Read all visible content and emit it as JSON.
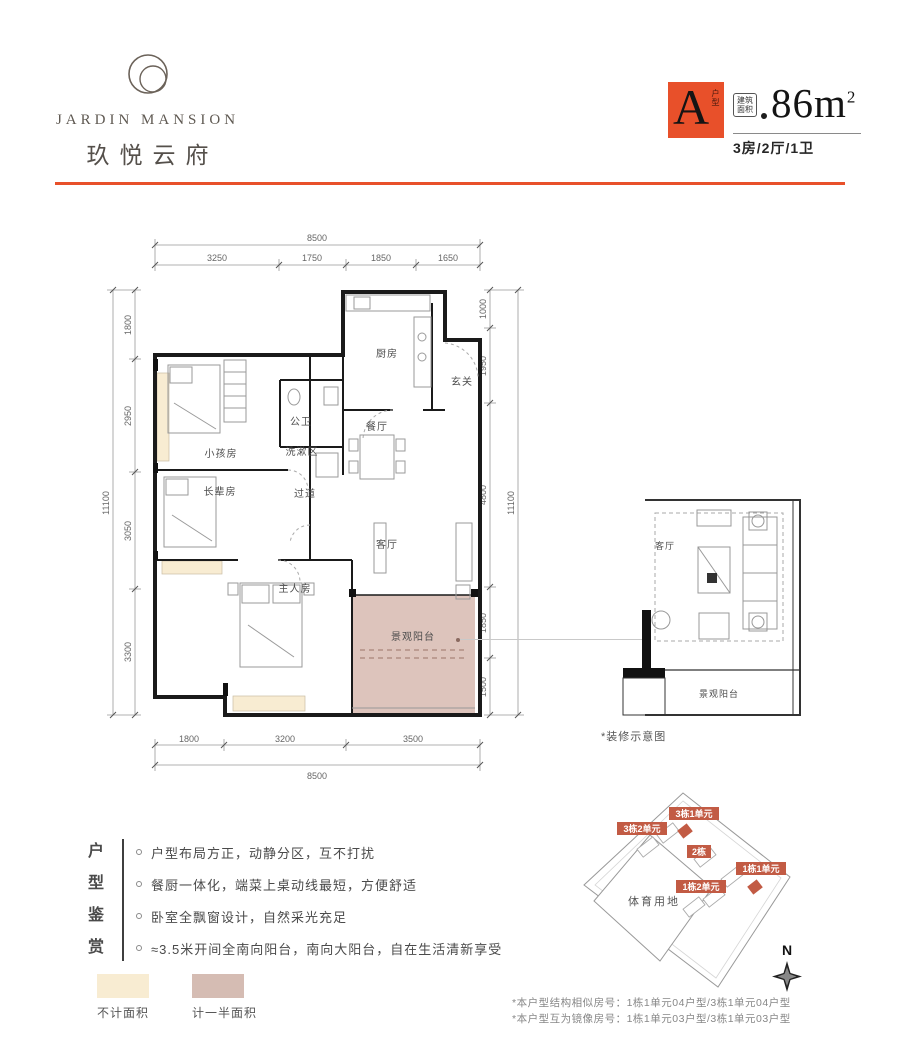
{
  "brand": {
    "logo_icon": "overlapping-circles",
    "name_en": "JARDIN MANSION",
    "name_cn": "玖悦云府"
  },
  "unit_badge": {
    "letter": "A",
    "letter_caption": "户型",
    "area_label_line1": "建筑",
    "area_label_line2": "面积",
    "area_value": "86m",
    "area_sup": "2",
    "layout": "3房/2厅/1卫"
  },
  "floor_plan": {
    "dims_top": {
      "total": "8500",
      "segments": [
        "3250",
        "1750",
        "1850",
        "1650"
      ]
    },
    "dims_left": {
      "total": "11100",
      "segments": [
        "1800",
        "2950",
        "3050",
        "3300"
      ]
    },
    "dims_right": {
      "total": "11100",
      "segments": [
        "1000",
        "1950",
        "4800",
        "1850",
        "1500"
      ]
    },
    "dims_bottom": {
      "total": "8500",
      "segments": [
        "1800",
        "3200",
        "3500"
      ]
    },
    "rooms": {
      "kitchen": "厨房",
      "entry": "玄关",
      "guest_bath": "公卫",
      "wash_area": "洗漱区",
      "dining": "餐厅",
      "kids_room": "小孩房",
      "elders_room": "长辈房",
      "corridor": "过道",
      "living": "客厅",
      "master_room": "主人房",
      "balcony": "景观阳台"
    }
  },
  "detail_plan": {
    "living": "客厅",
    "balcony": "景观阳台",
    "caption": "*装修示意图"
  },
  "features": {
    "title_chars": [
      "户",
      "型",
      "鉴",
      "赏"
    ],
    "items": [
      "户型布局方正，动静分区，互不打扰",
      "餐厨一体化，端菜上桌动线最短，方便舒适",
      "卧室全飘窗设计，自然采光充足",
      "≈3.5米开间全南向阳台，南向大阳台，自在生活清新享受"
    ]
  },
  "legend": {
    "items": [
      {
        "label": "不计面积",
        "color": "#F8ECD2"
      },
      {
        "label": "计一半面积",
        "color": "#D5BCB3"
      }
    ]
  },
  "site_plan": {
    "land_label": "体育用地",
    "building_tags": [
      "3栋1单元",
      "3栋2单元",
      "2栋",
      "1栋1单元",
      "1栋2单元"
    ],
    "compass": "N"
  },
  "notes": [
    "*本户型结构相似房号：1栋1单元04户型/3栋1单元04户型",
    "*本户型互为镜像房号：1栋1单元03户型/3栋1单元03户型"
  ],
  "colors": {
    "accent": "#E8502A",
    "cream": "#F8ECD2",
    "mauve": "#D5BCB3",
    "balcony_fill": "#D9BEB5",
    "tag_red": "#C25B44"
  }
}
